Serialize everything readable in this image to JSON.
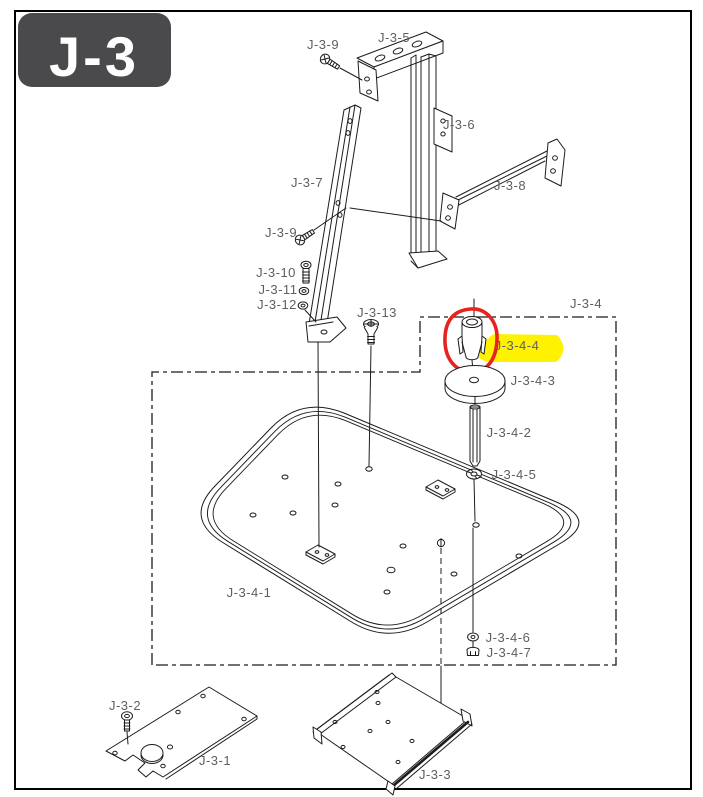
{
  "title_block": {
    "label": "J-3"
  },
  "colors": {
    "background": "#ffffff",
    "page_border": "#000000",
    "title_bg": "#4a4a4c",
    "title_text": "#ffffff",
    "line": "#1c1c1c",
    "label_text": "#5d5f61",
    "highlight_yellow": "#fff200",
    "callout_red": "#e8231f"
  },
  "highlighted_part": {
    "id": "J-3-4-4",
    "marker": "yellow-highlight",
    "callout": "red-circle"
  },
  "labels": [
    {
      "text": "J-3-9"
    },
    {
      "text": "J-3-5"
    },
    {
      "text": "J-3-6"
    },
    {
      "text": "J-3-7"
    },
    {
      "text": "J-3-8"
    },
    {
      "text": "J-3-9"
    },
    {
      "text": "J-3-10"
    },
    {
      "text": "J-3-11"
    },
    {
      "text": "J-3-12"
    },
    {
      "text": "J-3-13"
    },
    {
      "text": "J-3-4"
    },
    {
      "text": "J-3-4-4"
    },
    {
      "text": "J-3-4-3"
    },
    {
      "text": "J-3-4-2"
    },
    {
      "text": "J-3-4-5"
    },
    {
      "text": "J-3-4-1"
    },
    {
      "text": "J-3-4-6"
    },
    {
      "text": "J-3-4-7"
    },
    {
      "text": "J-3-2"
    },
    {
      "text": "J-3-1"
    },
    {
      "text": "J-3-3"
    }
  ]
}
